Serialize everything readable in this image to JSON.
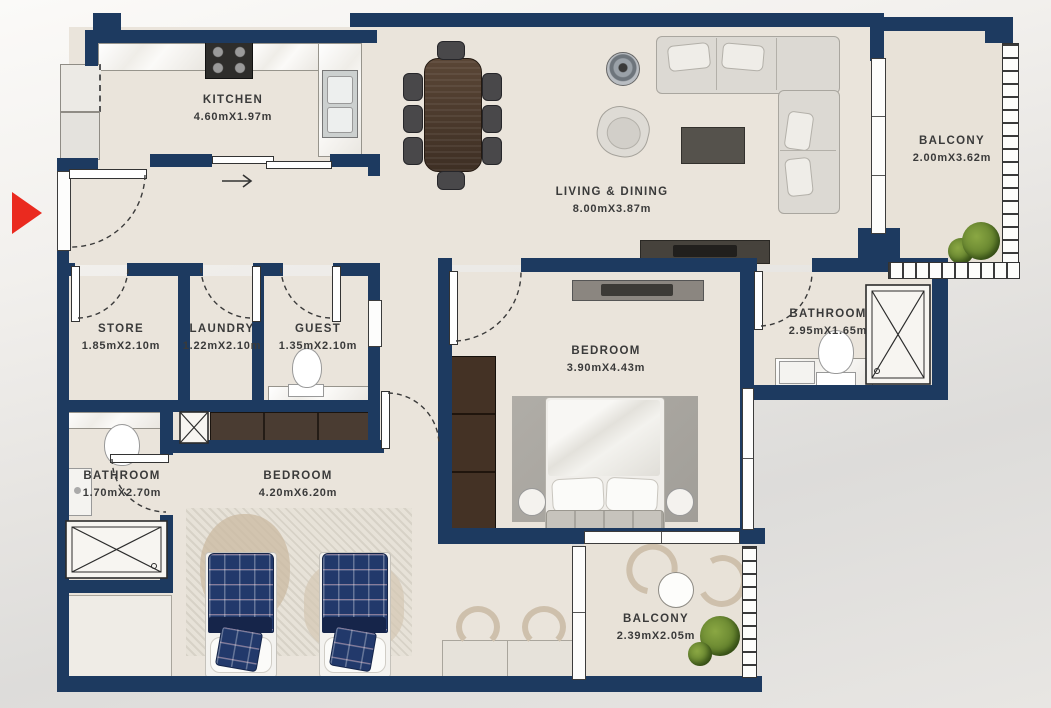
{
  "colors": {
    "wall": "#1d3a60",
    "floor_tile": "#eae4db",
    "entry_marker": "#ea2a1f",
    "bed_plaid": "#22396b",
    "sofa": "#dcd9d3",
    "wood_dark": "#3c2f26"
  },
  "icons": {
    "entry_marker": "right-pointing-triangle",
    "shower": "crossed-box",
    "shaft": "crossed-box",
    "door_swing": "dashed-quarter-arc",
    "sliding_door_direction": "right-arrow"
  },
  "rooms": {
    "kitchen": {
      "name": "KITCHEN",
      "dims": "4.60mX1.97m"
    },
    "living_dining": {
      "name": "LIVING & DINING",
      "dims": "8.00mX3.87m"
    },
    "balcony_top": {
      "name": "BALCONY",
      "dims": "2.00mX3.62m"
    },
    "store": {
      "name": "STORE",
      "dims": "1.85mX2.10m"
    },
    "laundry": {
      "name": "LAUNDRY",
      "dims": "1.22mX2.10m"
    },
    "guest": {
      "name": "GUEST",
      "dims": "1.35mX2.10m"
    },
    "bathroom_right": {
      "name": "BATHROOM",
      "dims": "2.95mX1.65m"
    },
    "bedroom_master": {
      "name": "BEDROOM",
      "dims": "3.90mX4.43m"
    },
    "bathroom_left": {
      "name": "BATHROOM",
      "dims": "1.70mX2.70m"
    },
    "bedroom_second": {
      "name": "BEDROOM",
      "dims": "4.20mX6.20m"
    },
    "balcony_bottom": {
      "name": "BALCONY",
      "dims": "2.39mX2.05m"
    }
  }
}
